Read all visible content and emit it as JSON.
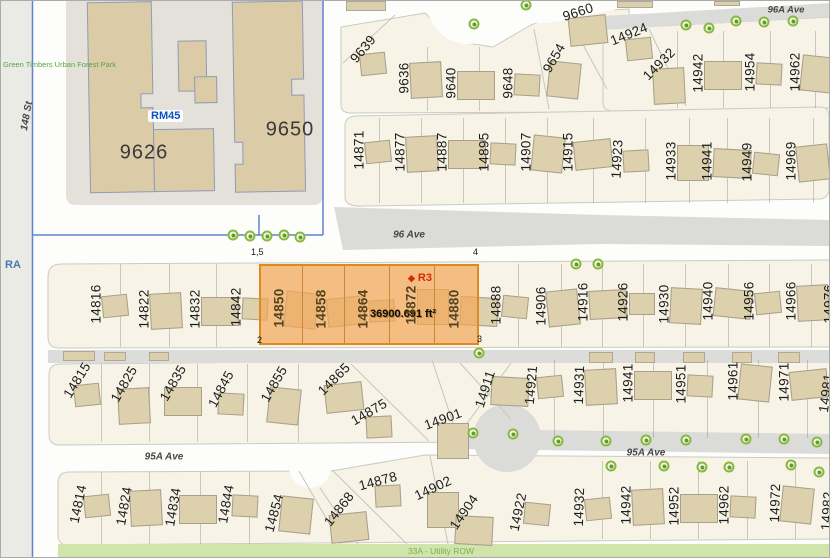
{
  "colors": {
    "highlight_fill": "#F2A659",
    "highlight_border": "#DE8A24",
    "zone_blue": "#0B50C8",
    "zone_red": "#D22D00",
    "park_green": "#58A63F",
    "utility_green": "#7CB14C",
    "tree_green": "#8AB83E",
    "road_gray": "#DBDBD9",
    "block_cream": "#F7F3E6",
    "building_tan": "#DDD0AD"
  },
  "region_labels": {
    "park": "Green Timbers Urban Forest Park",
    "ra_zone": "RA",
    "rm45_zone": "RM45",
    "r3_zone": "R3",
    "utility_row": "33A - Utility ROW"
  },
  "street_labels": {
    "st_148": "148 St",
    "ave_96": "96 Ave",
    "ave_96a": "96A Ave",
    "ave_95a": "95A Ave"
  },
  "large_building_numbers": {
    "left": "9626",
    "right": "9650"
  },
  "selected_parcel": {
    "area": "36900.691 ft²",
    "zoning": "R3",
    "corner_tl": "1,5",
    "corner_tr": "4",
    "corner_bl": "2",
    "corner_br": "3",
    "lot_numbers": [
      "14850",
      "14858",
      "14864",
      "14872",
      "14880"
    ]
  },
  "rows": [
    {
      "top": 46,
      "bottom": 110,
      "dividers": [
        426,
        478
      ],
      "lots": [
        {
          "t": "9639",
          "x": 362,
          "y": 48,
          "r": -50
        },
        {
          "t": "9636",
          "x": 403,
          "y": 77,
          "r": -90
        },
        {
          "t": "9640",
          "x": 450,
          "y": 82,
          "r": -90
        },
        {
          "t": "9648",
          "x": 507,
          "y": 82,
          "r": -90
        },
        {
          "t": "9654",
          "x": 553,
          "y": 57,
          "r": -60
        },
        {
          "t": "9660",
          "x": 577,
          "y": 11,
          "r": -18
        }
      ]
    },
    {
      "top": 30,
      "bottom": 107,
      "dividers": [
        676,
        722,
        769,
        814
      ],
      "lots": [
        {
          "t": "14924",
          "x": 628,
          "y": 33,
          "r": -22
        },
        {
          "t": "14932",
          "x": 658,
          "y": 63,
          "r": -45
        },
        {
          "t": "14942",
          "x": 697,
          "y": 72,
          "r": -90
        },
        {
          "t": "14954",
          "x": 749,
          "y": 71,
          "r": -90
        },
        {
          "t": "14962",
          "x": 794,
          "y": 71,
          "r": -90
        }
      ]
    },
    {
      "top": 117,
      "bottom": 202,
      "dividers": [
        378,
        420,
        462,
        504,
        546,
        592,
        644,
        688,
        726,
        768,
        812
      ],
      "lots": [
        {
          "t": "14871",
          "x": 358,
          "y": 149,
          "r": -90
        },
        {
          "t": "14877",
          "x": 399,
          "y": 151,
          "r": -90
        },
        {
          "t": "14887",
          "x": 441,
          "y": 151,
          "r": -90
        },
        {
          "t": "14895",
          "x": 483,
          "y": 151,
          "r": -90
        },
        {
          "t": "14907",
          "x": 525,
          "y": 151,
          "r": -90
        },
        {
          "t": "14915",
          "x": 567,
          "y": 151,
          "r": -90
        },
        {
          "t": "14923",
          "x": 616,
          "y": 158,
          "r": -87
        },
        {
          "t": "14933",
          "x": 670,
          "y": 160,
          "r": -90
        },
        {
          "t": "14941",
          "x": 706,
          "y": 160,
          "r": -90
        },
        {
          "t": "14949",
          "x": 746,
          "y": 161,
          "r": -90
        },
        {
          "t": "14969",
          "x": 790,
          "y": 160,
          "r": -90
        }
      ]
    },
    {
      "top": 263,
      "bottom": 346,
      "dividers": [
        119,
        168,
        215,
        517,
        560,
        601,
        642,
        684,
        727,
        768,
        810
      ],
      "lots": [
        {
          "t": "14816",
          "x": 95,
          "y": 303,
          "r": -90
        },
        {
          "t": "14822",
          "x": 143,
          "y": 308,
          "r": -90
        },
        {
          "t": "14832",
          "x": 194,
          "y": 308,
          "r": -90
        },
        {
          "t": "14842",
          "x": 235,
          "y": 306,
          "r": -90
        },
        {
          "t": "14850",
          "x": 278,
          "y": 307,
          "r": -90
        },
        {
          "t": "14858",
          "x": 320,
          "y": 308,
          "r": -90
        },
        {
          "t": "14864",
          "x": 362,
          "y": 308,
          "r": -90
        },
        {
          "t": "14872",
          "x": 410,
          "y": 304,
          "r": -90
        },
        {
          "t": "14880",
          "x": 453,
          "y": 308,
          "r": -90
        },
        {
          "t": "14888",
          "x": 495,
          "y": 304,
          "r": -90
        },
        {
          "t": "14906",
          "x": 540,
          "y": 305,
          "r": -90
        },
        {
          "t": "14916",
          "x": 582,
          "y": 301,
          "r": -90
        },
        {
          "t": "14926",
          "x": 622,
          "y": 301,
          "r": -90
        },
        {
          "t": "14930",
          "x": 663,
          "y": 303,
          "r": -90
        },
        {
          "t": "14940",
          "x": 707,
          "y": 300,
          "r": -90
        },
        {
          "t": "14956",
          "x": 748,
          "y": 300,
          "r": -90
        },
        {
          "t": "14966",
          "x": 790,
          "y": 300,
          "r": -90
        },
        {
          "t": "14976",
          "x": 828,
          "y": 303,
          "r": -90
        }
      ]
    },
    {
      "top": 363,
      "bottom": 441,
      "dividers": [
        100,
        148,
        196,
        246,
        297
      ],
      "lots": [
        {
          "t": "14815",
          "x": 76,
          "y": 379,
          "r": -58
        },
        {
          "t": "14825",
          "x": 123,
          "y": 383,
          "r": -60
        },
        {
          "t": "14835",
          "x": 172,
          "y": 382,
          "r": -60
        },
        {
          "t": "14845",
          "x": 220,
          "y": 388,
          "r": -62
        },
        {
          "t": "14855",
          "x": 273,
          "y": 383,
          "r": -60
        },
        {
          "t": "14865",
          "x": 333,
          "y": 378,
          "r": -45
        },
        {
          "t": "14875",
          "x": 368,
          "y": 411,
          "r": -30
        },
        {
          "t": "14901",
          "x": 442,
          "y": 418,
          "r": -20
        },
        {
          "t": "14911",
          "x": 484,
          "y": 388,
          "r": -72
        }
      ]
    },
    {
      "top": 359,
      "bottom": 437,
      "dividers": [
        553,
        602,
        652,
        706,
        757,
        806
      ],
      "lots": [
        {
          "t": "14921",
          "x": 530,
          "y": 384,
          "r": -85
        },
        {
          "t": "14931",
          "x": 578,
          "y": 384,
          "r": -88
        },
        {
          "t": "14941",
          "x": 627,
          "y": 382,
          "r": -90
        },
        {
          "t": "14951",
          "x": 680,
          "y": 383,
          "r": -90
        },
        {
          "t": "14961",
          "x": 732,
          "y": 380,
          "r": -90
        },
        {
          "t": "14971",
          "x": 783,
          "y": 381,
          "r": -90
        },
        {
          "t": "14981",
          "x": 825,
          "y": 392,
          "r": -82
        }
      ]
    },
    {
      "top": 471,
      "bottom": 543,
      "dividers": [
        100,
        148,
        199,
        248
      ],
      "lots": [
        {
          "t": "14814",
          "x": 77,
          "y": 503,
          "r": -78
        },
        {
          "t": "14824",
          "x": 123,
          "y": 505,
          "r": -80
        },
        {
          "t": "14834",
          "x": 172,
          "y": 506,
          "r": -80
        },
        {
          "t": "14844",
          "x": 225,
          "y": 503,
          "r": -80
        },
        {
          "t": "14854",
          "x": 273,
          "y": 512,
          "r": -75
        },
        {
          "t": "14868",
          "x": 338,
          "y": 508,
          "r": -52
        },
        {
          "t": "14878",
          "x": 377,
          "y": 480,
          "r": -15
        },
        {
          "t": "14902",
          "x": 432,
          "y": 487,
          "r": -25
        },
        {
          "t": "14904",
          "x": 463,
          "y": 511,
          "r": -55
        },
        {
          "t": "14922",
          "x": 517,
          "y": 511,
          "r": -78
        }
      ]
    },
    {
      "top": 460,
      "bottom": 538,
      "dividers": [
        601,
        649,
        697,
        746,
        794
      ],
      "lots": [
        {
          "t": "14932",
          "x": 578,
          "y": 506,
          "r": -88
        },
        {
          "t": "14942",
          "x": 625,
          "y": 504,
          "r": -90
        },
        {
          "t": "14952",
          "x": 673,
          "y": 505,
          "r": -90
        },
        {
          "t": "14962",
          "x": 723,
          "y": 504,
          "r": -90
        },
        {
          "t": "14972",
          "x": 774,
          "y": 502,
          "r": -88
        },
        {
          "t": "14982",
          "x": 826,
          "y": 510,
          "r": -86
        }
      ]
    }
  ],
  "trees": [
    [
      473,
      23
    ],
    [
      525,
      4
    ],
    [
      685,
      24
    ],
    [
      708,
      27
    ],
    [
      735,
      20
    ],
    [
      763,
      21
    ],
    [
      792,
      20
    ],
    [
      232,
      234
    ],
    [
      249,
      235
    ],
    [
      266,
      235
    ],
    [
      283,
      234
    ],
    [
      299,
      236
    ],
    [
      575,
      263
    ],
    [
      597,
      263
    ],
    [
      478,
      352
    ],
    [
      472,
      432
    ],
    [
      512,
      433
    ],
    [
      557,
      440
    ],
    [
      605,
      440
    ],
    [
      645,
      439
    ],
    [
      685,
      439
    ],
    [
      745,
      438
    ],
    [
      783,
      438
    ],
    [
      816,
      441
    ],
    [
      610,
      465
    ],
    [
      663,
      465
    ],
    [
      701,
      466
    ],
    [
      728,
      466
    ],
    [
      790,
      464
    ],
    [
      818,
      471
    ]
  ]
}
